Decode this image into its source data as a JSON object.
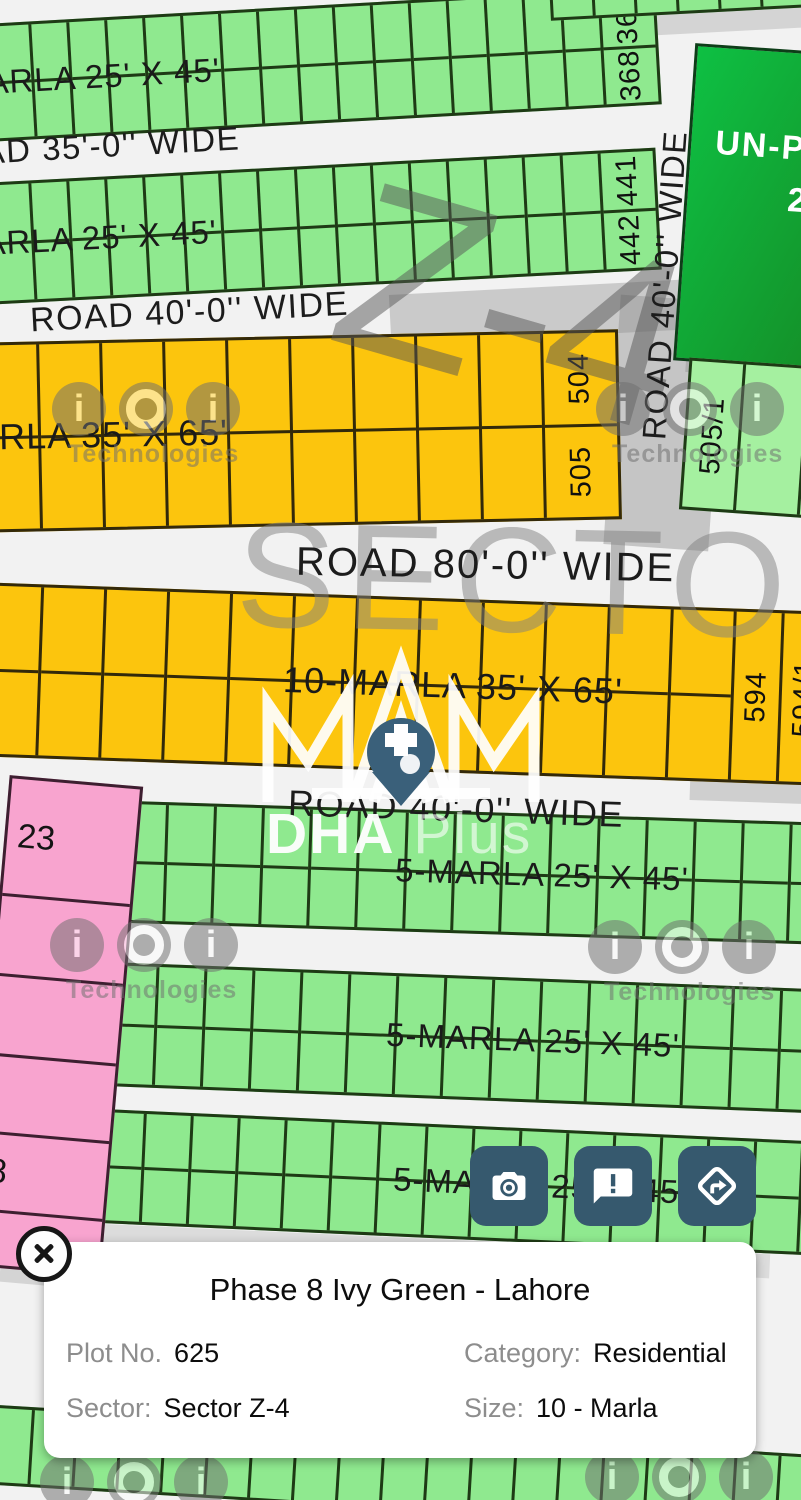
{
  "watermarks": {
    "brand_text": "Technologies",
    "sector_big": "SECTOR",
    "zone_big": "Z-4",
    "logo_main": "DHA",
    "logo_suffix": "Plus"
  },
  "map": {
    "road_labels": {
      "horizontal_35": "ROAD 35'-0'' WIDE",
      "horizontal_40_top": "ROAD 40'-0'' WIDE",
      "horizontal_80": "ROAD 80'-0'' WIDE",
      "horizontal_40_mid": "ROAD 40'-0'' WIDE",
      "vertical_40": "ROAD 40'-0'' WIDE"
    },
    "bands": [
      {
        "kind": "green",
        "label": "5-MARLA 25' X 45'",
        "numbers": [
          "367",
          "368"
        ]
      },
      {
        "kind": "green",
        "label": "5-MARLA 25' X 45'",
        "numbers": [
          "441",
          "442"
        ]
      },
      {
        "kind": "orange",
        "label": "10-MARLA 35' X 65'",
        "numbers": [
          "504",
          "505"
        ]
      },
      {
        "kind": "orange",
        "label": "10-MARLA 35' X 65'",
        "numbers": [
          "594",
          "594/1"
        ]
      },
      {
        "kind": "green",
        "label": "5-MARLA 25' X 45'",
        "numbers": [
          "639",
          "696"
        ]
      },
      {
        "kind": "green",
        "label": "5-MARLA 25' X 45'",
        "numbers": [
          "697",
          "754"
        ]
      },
      {
        "kind": "green",
        "label": "5-MARLA 25' X 45'",
        "numbers": [
          "755",
          "812"
        ]
      },
      {
        "kind": "green",
        "label": "",
        "numbers": []
      }
    ],
    "pink_numbers": [
      "23",
      "8"
    ],
    "side_plot_number": "505/1",
    "unplanned": {
      "line1": "UN-P",
      "line2": "2"
    }
  },
  "action_buttons": [
    {
      "name": "camera"
    },
    {
      "name": "report-issue"
    },
    {
      "name": "directions"
    }
  ],
  "info_card": {
    "title": "Phase 8 Ivy Green - Lahore",
    "fields": [
      {
        "label": "Plot No.",
        "value": "625"
      },
      {
        "label": "Category:",
        "value": "Residential"
      },
      {
        "label": "Sector:",
        "value": "Sector Z-4"
      },
      {
        "label": "Size:",
        "value": "10 - Marla"
      }
    ]
  },
  "colors": {
    "plot_green": "#8FE98F",
    "plot_orange": "#FCC50D",
    "plot_pink": "#F8A4CF",
    "unplanned_green": "#12A32F",
    "road_white": "#F2F2F2",
    "button_blue": "#36596E",
    "card_bg": "#FFFFFF"
  }
}
